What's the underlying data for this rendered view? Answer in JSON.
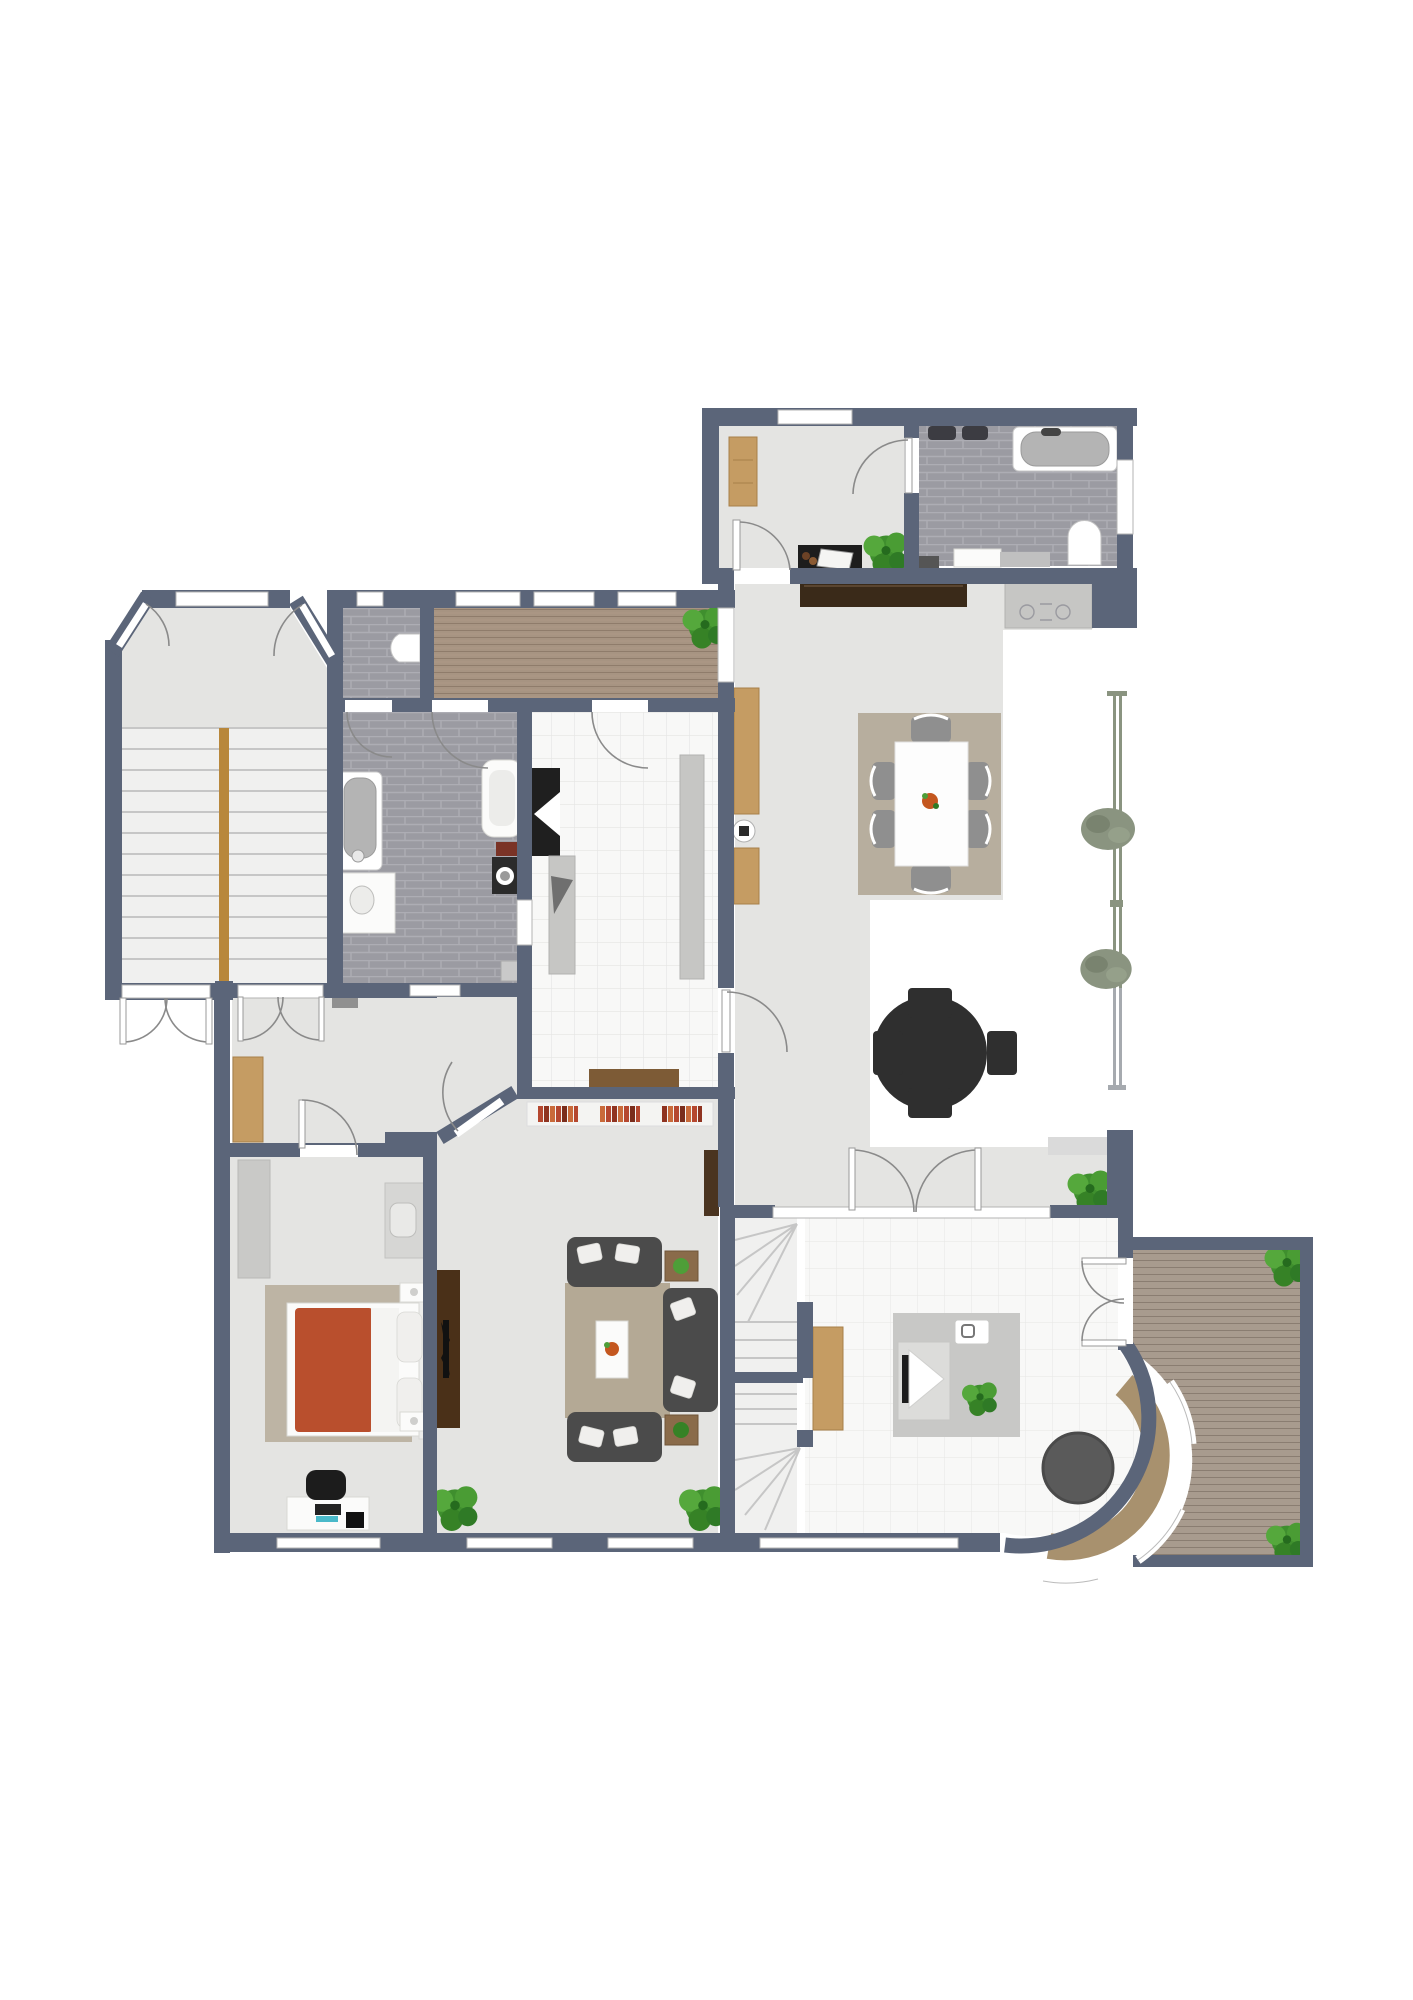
{
  "palette": {
    "wall": "#5b6579",
    "floor": "#e4e4e2",
    "exterior": "#ffffff",
    "bath_tile": "#9b9ba2",
    "bath_grout": "#adadb4",
    "tile_white": "#f8f8f7",
    "tile_line": "#e5e5e3",
    "wood_floor": "#a79482",
    "wood_line": "#8f7c6b",
    "deck": "#a89b8e",
    "deck_line": "#8a7d71",
    "rug_dining": "#b7ae9e",
    "rug_living": "#b4a995",
    "rug_bed": "#bdb4a4",
    "rug_office_gray": "#c8c8c6",
    "tan_cabinet": "#c59c63",
    "dark_wood": "#3a2a19",
    "brown_wood": "#7d5b36",
    "sofa": "#4b4b4b",
    "pillow": "#f0efed",
    "bed_red": "#b94f2d",
    "white_furniture": "#fbfbfa",
    "stair_rail": "#b8873b",
    "railing_green": "#8a9480",
    "railing_gray": "#a6aaaf",
    "plant_green": "#4e9e38",
    "plant_dark": "#2f7a26",
    "hedge_sage": "#8a9480",
    "counter": "#c6c6c4",
    "appliance_black": "#1f1f1f",
    "table_charcoal": "#2f2f2f",
    "book_red": "#b5472f",
    "book_orange": "#c96a3a",
    "bench_tan": "#a8916e",
    "round_table_gray": "#5a5a5a"
  },
  "plan": {
    "type": "residential-floor-plan",
    "rooms": [
      {
        "name": "study",
        "furniture": [
          "wardrobe",
          "desk-with-paper",
          "plant"
        ]
      },
      {
        "name": "upper-bathroom",
        "furniture": [
          "bathtub",
          "twin-wall-sinks",
          "toilet",
          "vanity",
          "scale"
        ]
      },
      {
        "name": "great-room",
        "furniture": [
          "dark-sideboard",
          "dining-table",
          "six-chairs",
          "dining-rug",
          "wall-cabinets",
          "round-stove",
          "kitchenette-counter"
        ]
      },
      {
        "name": "patio-terrace",
        "furniture": [
          "cross-table-with-chairs",
          "railing",
          "hedges",
          "plant"
        ]
      },
      {
        "name": "wood-corridor",
        "furniture": [
          "plant"
        ]
      },
      {
        "name": "wc",
        "furniture": [
          "toilet"
        ]
      },
      {
        "name": "stair-hall",
        "furniture": [
          "staircase",
          "handrail"
        ]
      },
      {
        "name": "main-bathroom",
        "furniture": [
          "bathtub",
          "vanity-sink",
          "shower-vanity",
          "washing-machine",
          "laundry-basket",
          "small-sink"
        ]
      },
      {
        "name": "kitchen",
        "furniture": [
          "oven-block",
          "counter-left",
          "counter-right",
          "sideboard"
        ]
      },
      {
        "name": "hallway",
        "furniture": [
          "wardrobe",
          "radiator"
        ]
      },
      {
        "name": "bedroom",
        "furniture": [
          "closet",
          "vanity-desk",
          "double-bed",
          "nightstands",
          "office-desk",
          "office-chair"
        ]
      },
      {
        "name": "living-room",
        "furniture": [
          "book-shelves",
          "tv-cabinet",
          "two-sofas",
          "chaise-sofa",
          "coffee-table",
          "side-tables",
          "plants"
        ]
      },
      {
        "name": "winder-stairs",
        "furniture": [
          "stair-treads"
        ]
      },
      {
        "name": "garden-room",
        "furniture": [
          "rug",
          "desk-with-laptop",
          "notepad",
          "round-table",
          "curved-bench",
          "tan-cabinet",
          "plant"
        ]
      },
      {
        "name": "roof-deck",
        "furniture": [
          "plants"
        ]
      }
    ]
  }
}
